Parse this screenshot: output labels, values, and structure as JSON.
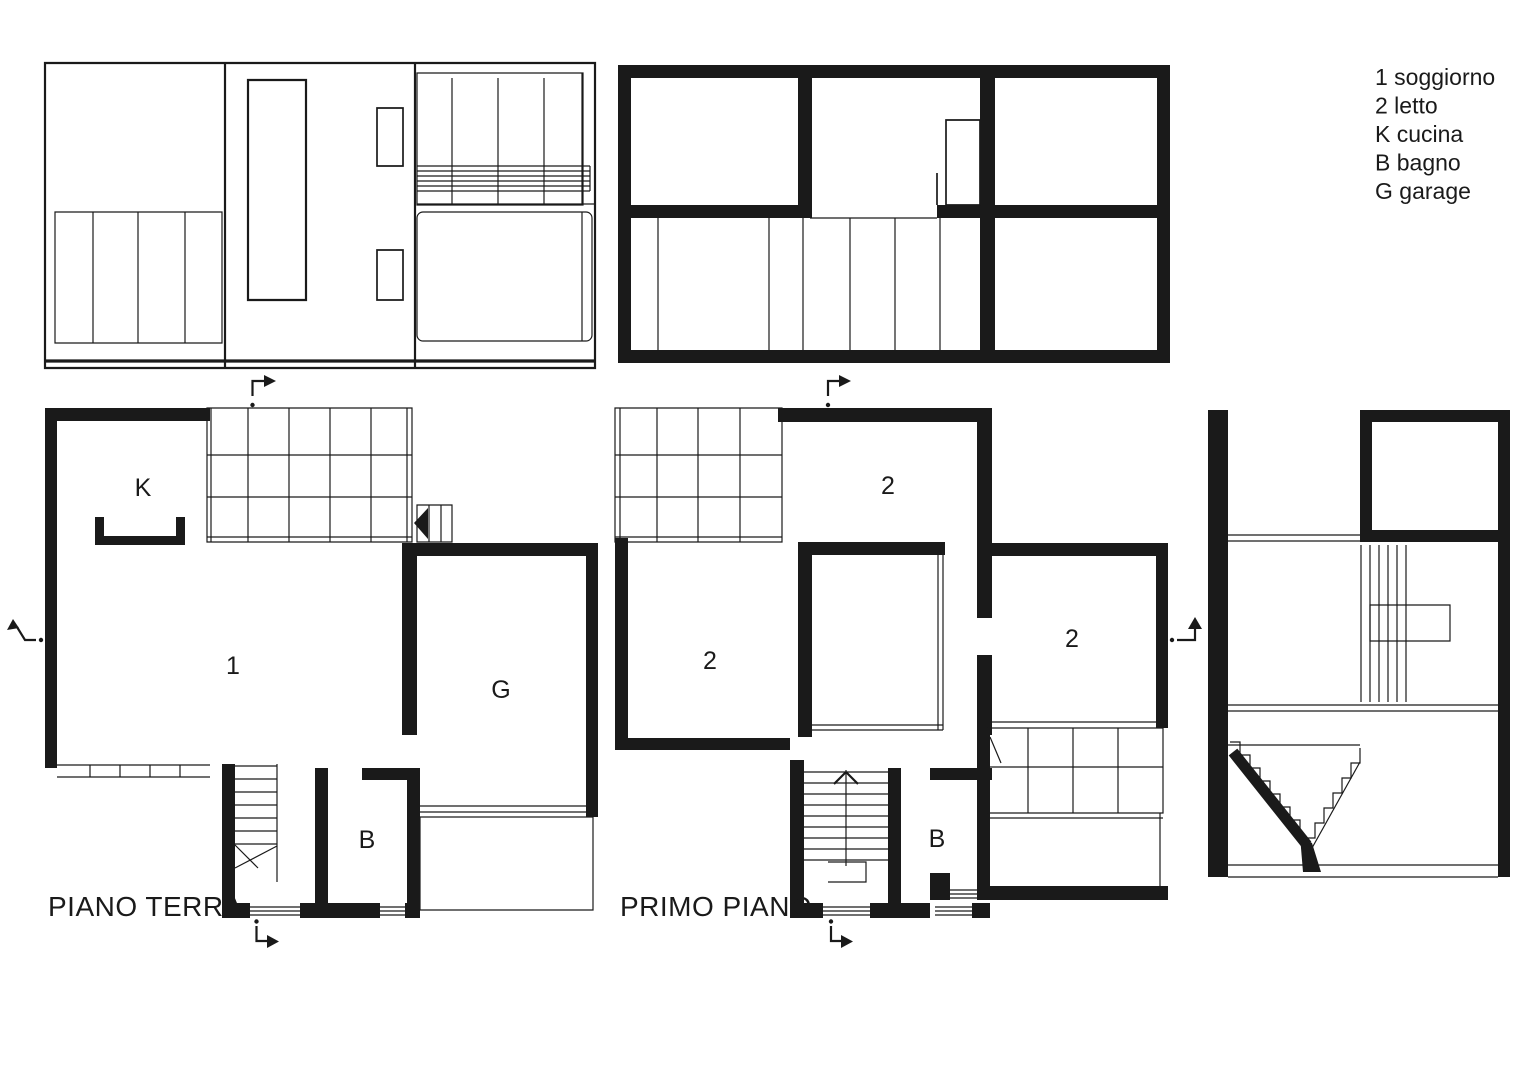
{
  "colors": {
    "ink": "#1a1a1a",
    "paper": "#ffffff"
  },
  "legend": {
    "items": [
      {
        "key": "1",
        "label": "soggiorno",
        "text": "1 soggiorno"
      },
      {
        "key": "2",
        "label": "letto",
        "text": "2 letto"
      },
      {
        "key": "K",
        "label": "cucina",
        "text": "K cucina"
      },
      {
        "key": "B",
        "label": "bagno",
        "text": "B bagno"
      },
      {
        "key": "G",
        "label": "garage",
        "text": "G garage"
      }
    ]
  },
  "ground_floor": {
    "title": "PIANO TERRA",
    "labels": {
      "kitchen": "K",
      "living": "1",
      "garage": "G",
      "bathroom": "B"
    }
  },
  "first_floor": {
    "title": "PRIMO PIANO",
    "labels": {
      "bedroom_left": "2",
      "bedroom_top": "2",
      "bedroom_right": "2",
      "bathroom": "B"
    }
  }
}
